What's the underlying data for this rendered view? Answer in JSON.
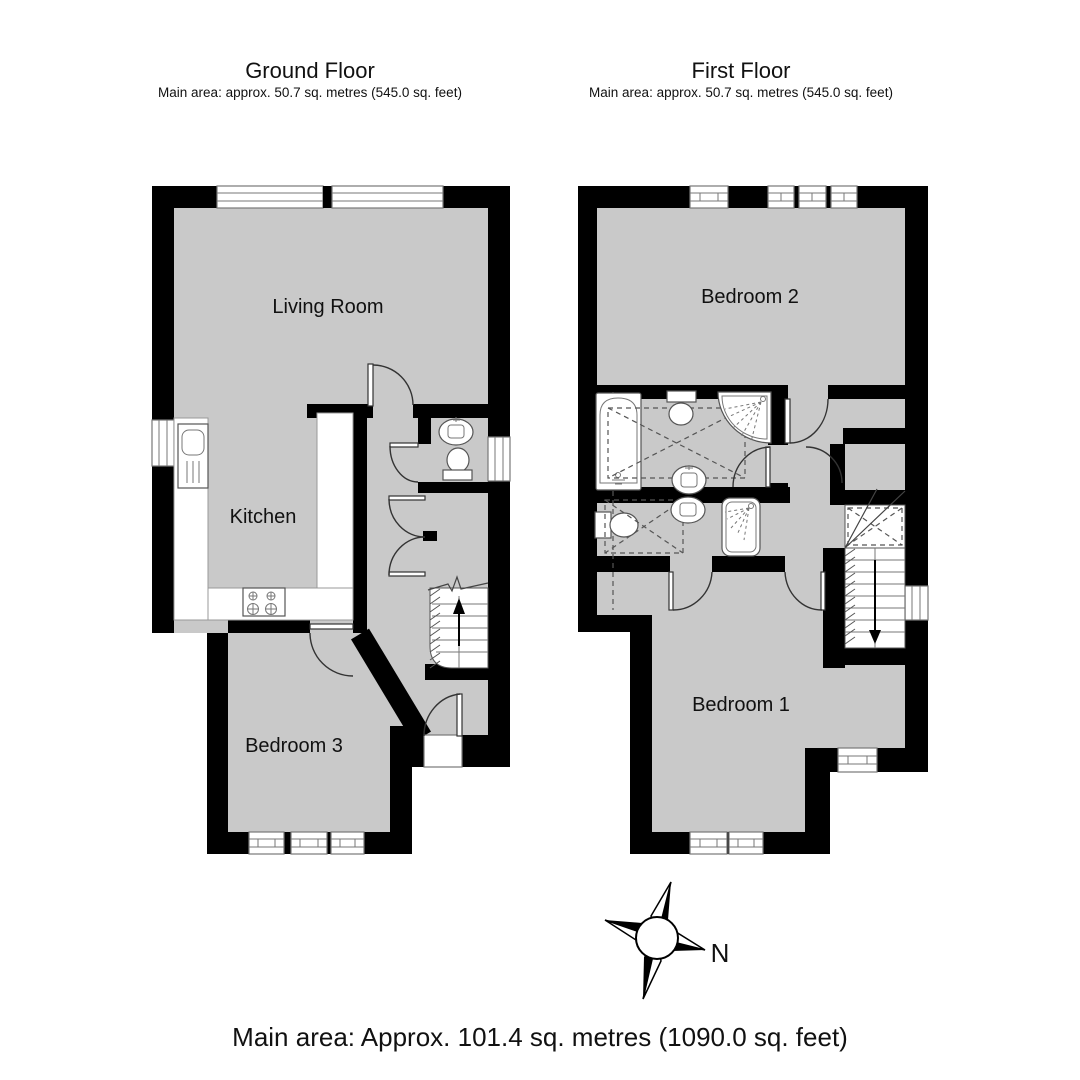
{
  "header": {
    "ground_floor": {
      "title": "Ground Floor",
      "subtitle": "Main area: approx. 50.7 sq. metres (545.0 sq. feet)"
    },
    "first_floor": {
      "title": "First Floor",
      "subtitle": "Main area: approx. 50.7 sq. metres (545.0 sq. feet)"
    }
  },
  "rooms": {
    "living_room": "Living Room",
    "kitchen": "Kitchen",
    "bedroom_3": "Bedroom 3",
    "bedroom_2": "Bedroom 2",
    "bedroom_1": "Bedroom 1"
  },
  "compass": {
    "north_label": "N"
  },
  "footer": {
    "total_area": "Main area: Approx. 101.4 sq. metres (1090.0 sq. feet)"
  },
  "colors": {
    "floor_fill": "#c9c9c9",
    "wall": "#000000"
  }
}
